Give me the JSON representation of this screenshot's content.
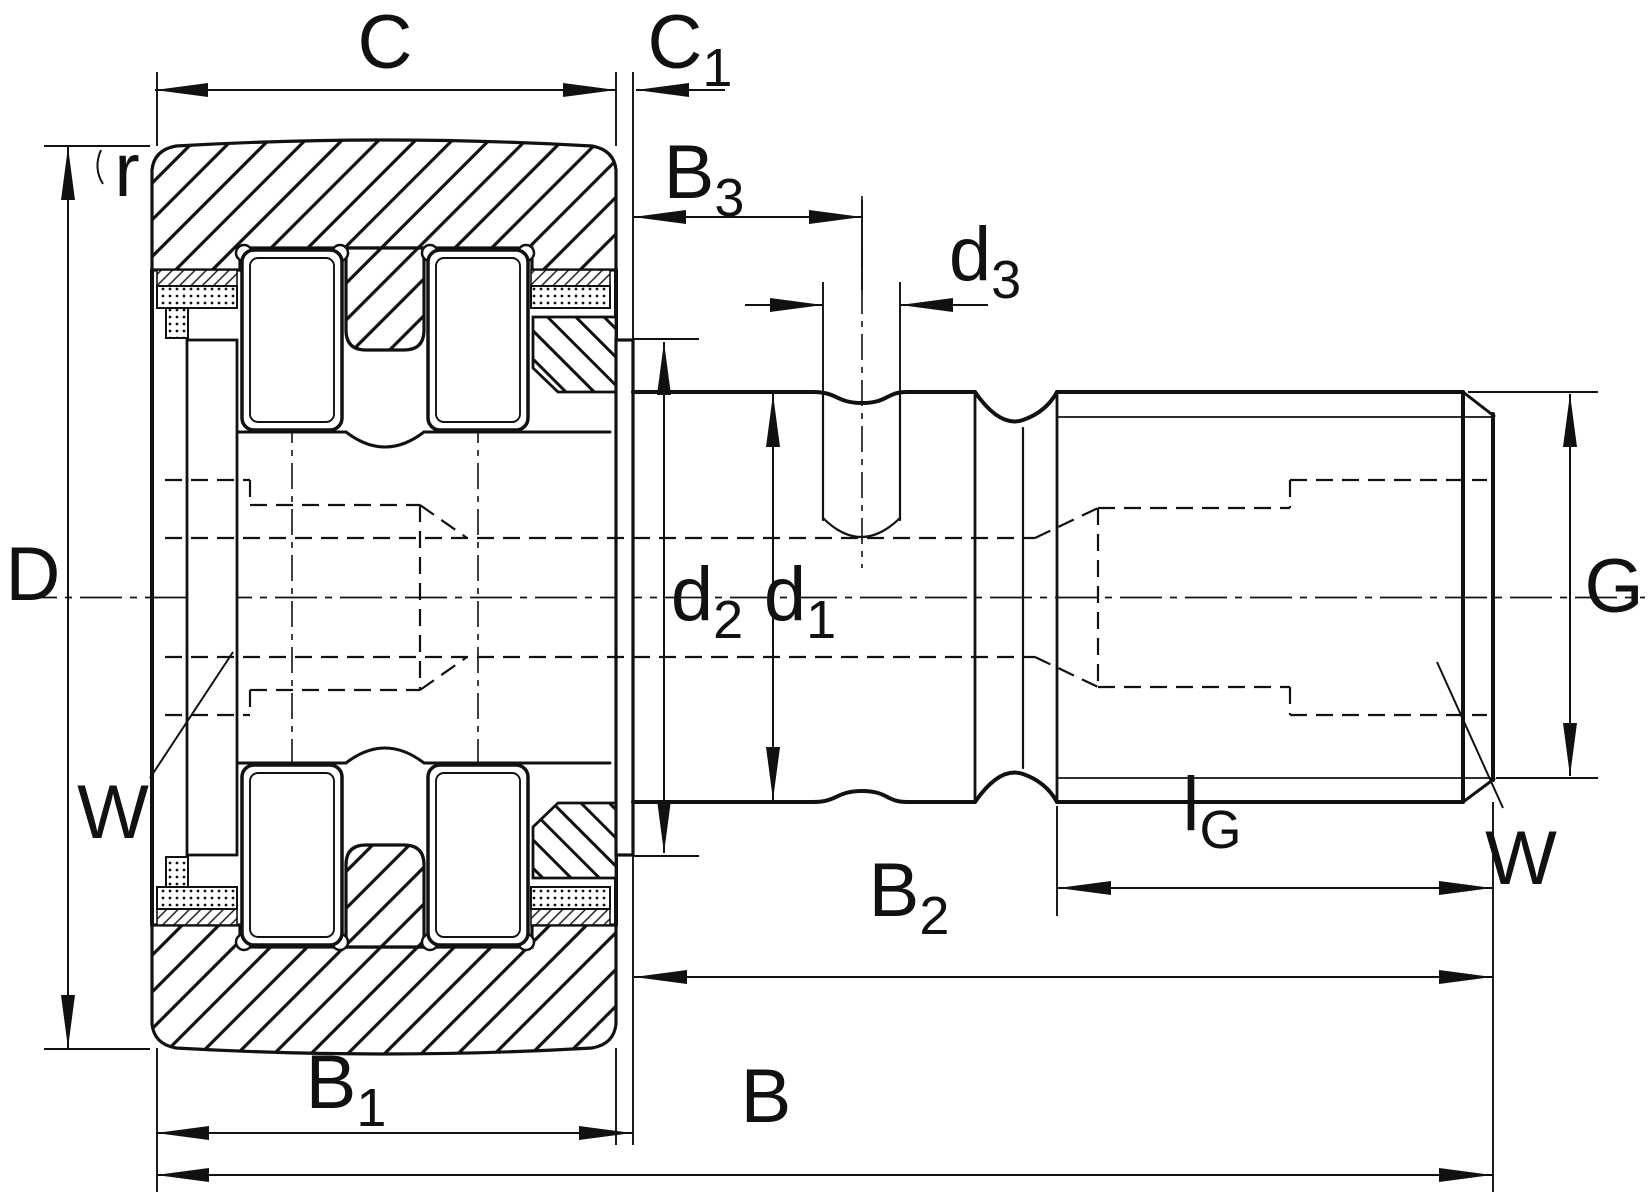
{
  "drawing": {
    "kind": "technical-cross-section",
    "component": "stud-type track roller cam follower with needle rollers, lubrication hole and threaded stud",
    "line_color": "#111111",
    "background_color": "#ffffff",
    "labels": {
      "c": {
        "text": "C"
      },
      "c1": {
        "text": "C",
        "sub": "1"
      },
      "b3": {
        "text": "B",
        "sub": "3"
      },
      "d3": {
        "text": "d",
        "sub": "3"
      },
      "dcap": {
        "text": "D"
      },
      "r": {
        "text": "r"
      },
      "w_left": {
        "text": "W"
      },
      "d2": {
        "text": "d",
        "sub": "2"
      },
      "d1": {
        "text": "d",
        "sub": "1"
      },
      "g": {
        "text": "G"
      },
      "lg": {
        "text": "l",
        "sub": "G"
      },
      "w_right": {
        "text": "W"
      },
      "b2": {
        "text": "B",
        "sub": "2"
      },
      "b1": {
        "text": "B",
        "sub": "1"
      },
      "b": {
        "text": "B"
      }
    }
  }
}
